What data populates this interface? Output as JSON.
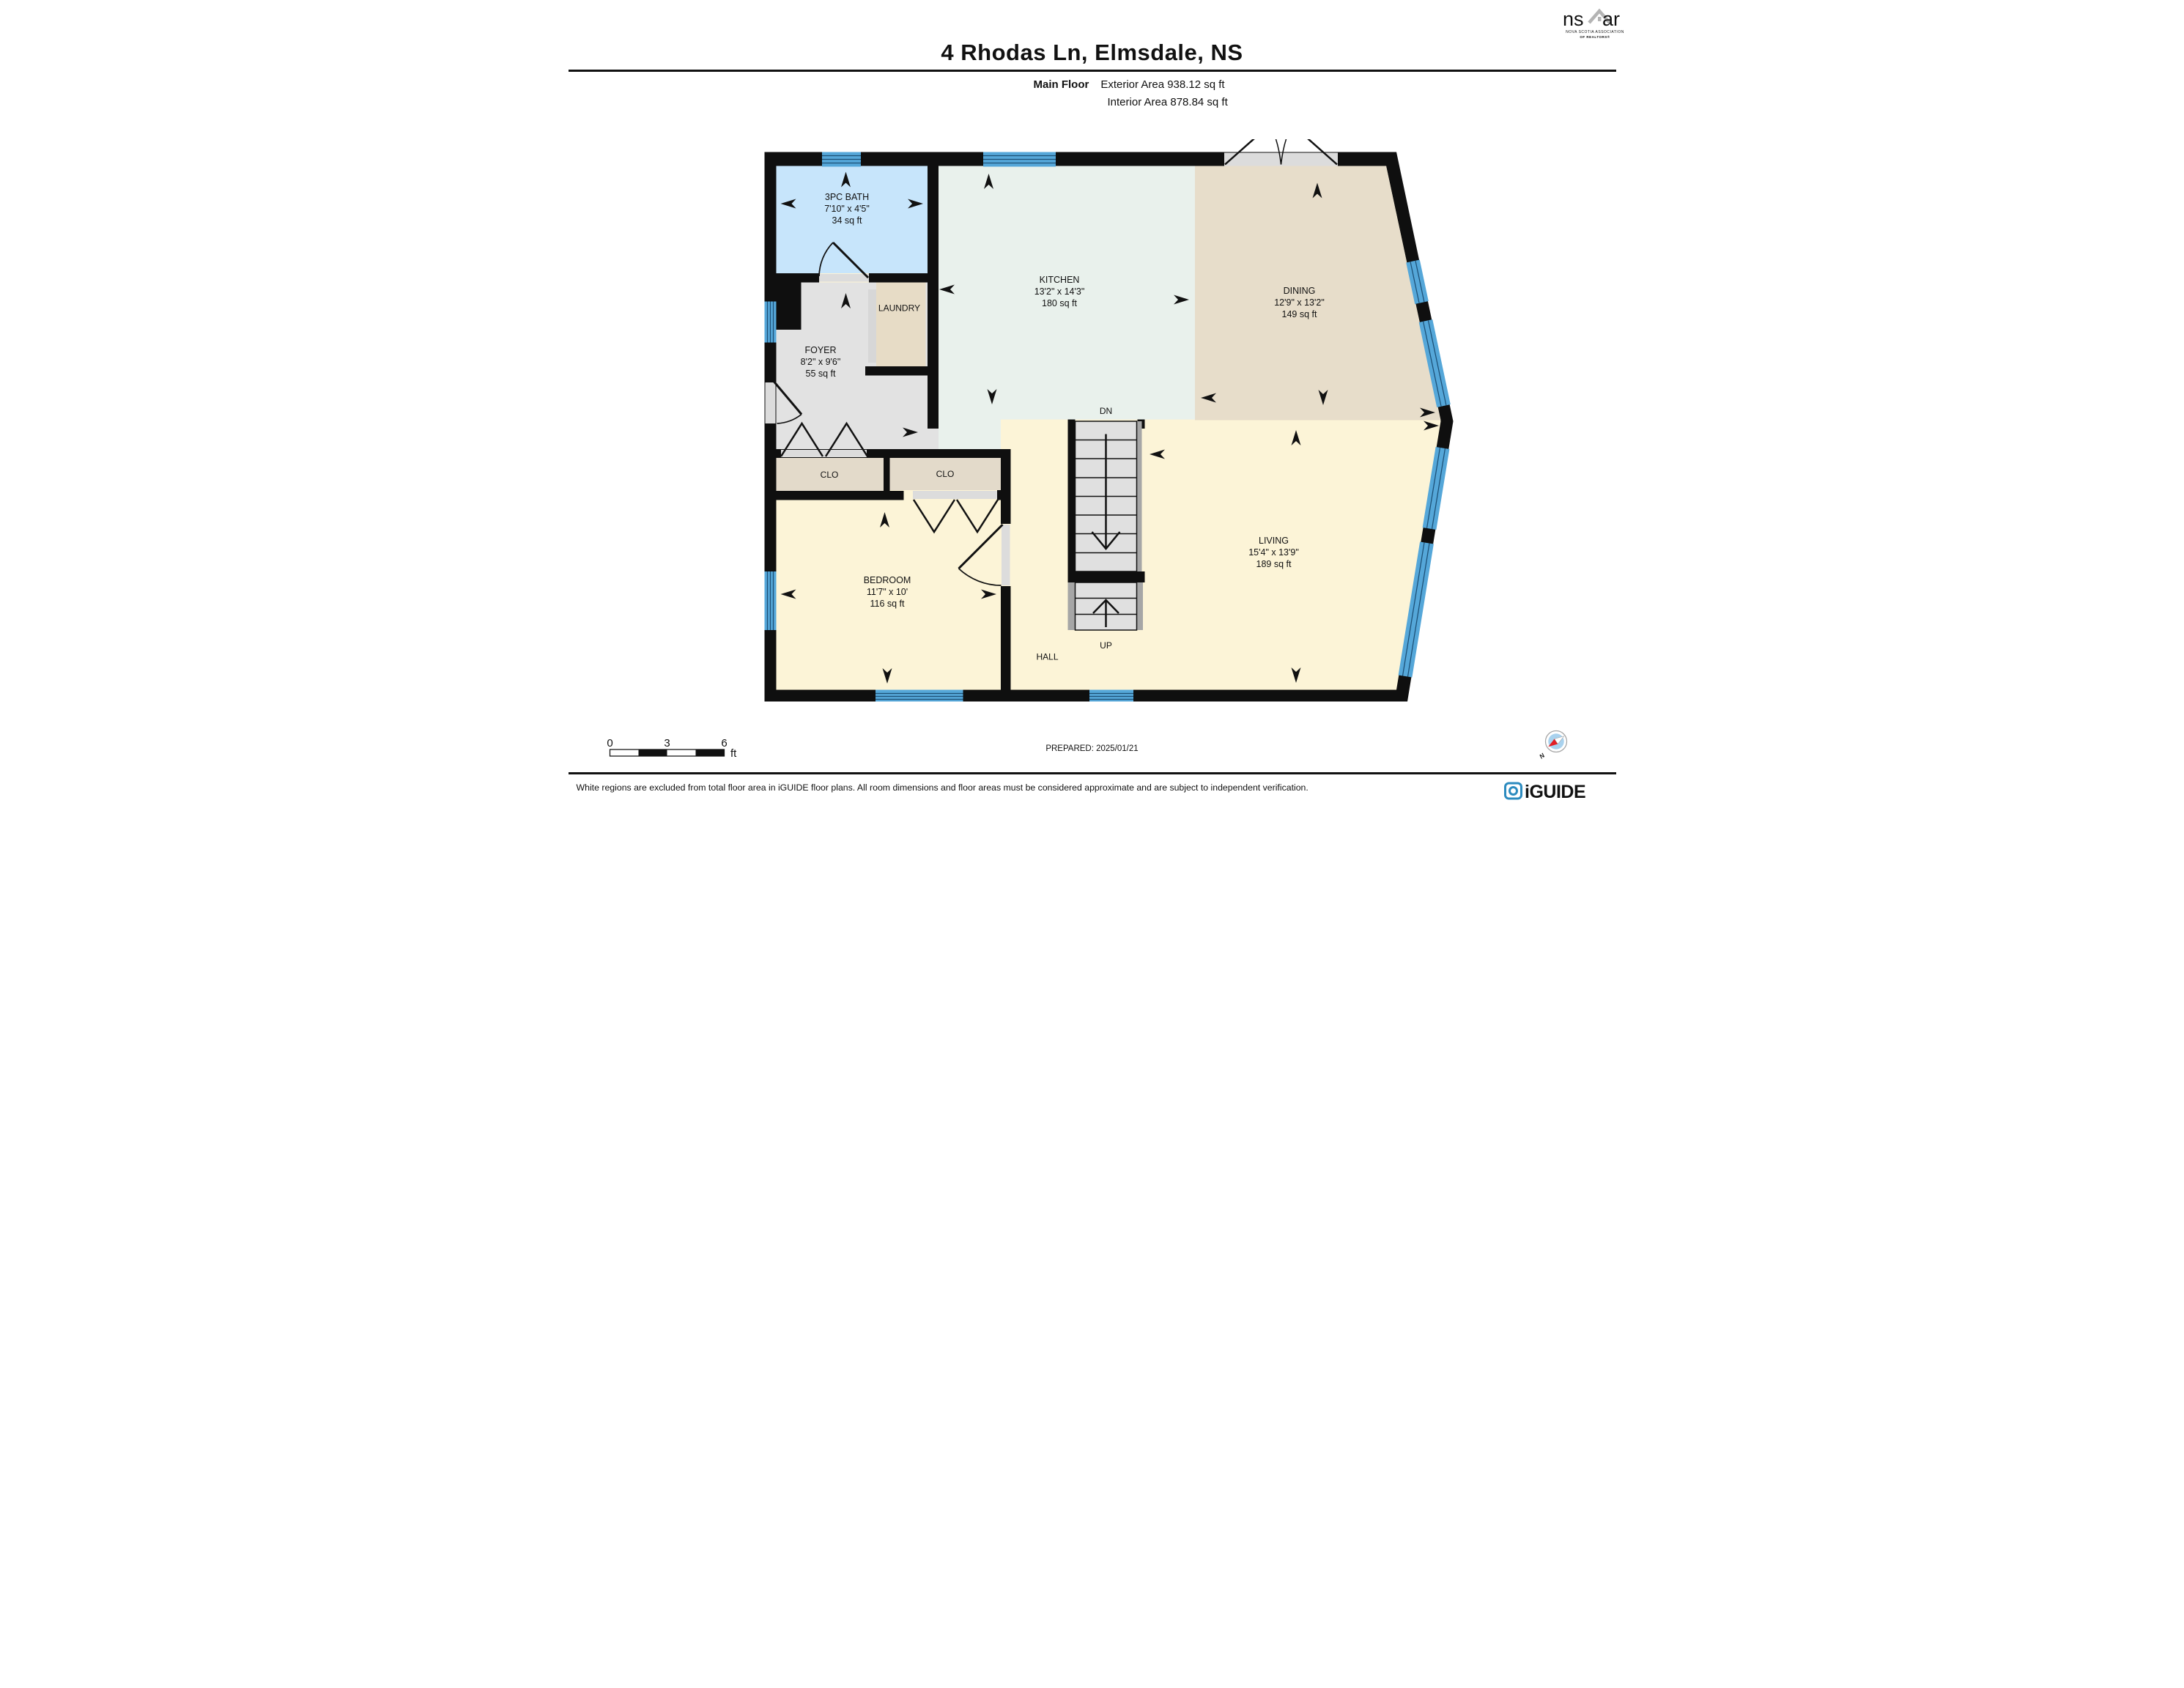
{
  "header": {
    "title": "4 Rhodas Ln, Elmsdale, NS",
    "floor_label": "Main Floor",
    "exterior_area": "Exterior Area 938.12 sq ft",
    "interior_area": "Interior Area 878.84 sq ft"
  },
  "rooms": {
    "bath": {
      "name": "3PC BATH",
      "dims": "7'10\" x 4'5\"",
      "area": "34 sq ft"
    },
    "kitchen": {
      "name": "KITCHEN",
      "dims": "13'2\" x 14'3\"",
      "area": "180 sq ft"
    },
    "dining": {
      "name": "DINING",
      "dims": "12'9\" x 13'2\"",
      "area": "149 sq ft"
    },
    "living": {
      "name": "LIVING",
      "dims": "15'4\" x 13'9\"",
      "area": "189 sq ft"
    },
    "bedroom": {
      "name": "BEDROOM",
      "dims": "11'7\" x 10'",
      "area": "116 sq ft"
    },
    "foyer": {
      "name": "FOYER",
      "dims": "8'2\" x 9'6\"",
      "area": "55 sq ft"
    },
    "laundry": {
      "name": "LAUNDRY"
    },
    "closet_left": {
      "name": "CLO"
    },
    "closet_right": {
      "name": "CLO"
    },
    "hall": {
      "name": "HALL"
    }
  },
  "stairs": {
    "down_label": "DN",
    "up_label": "UP"
  },
  "scale_bar": {
    "tick_0": "0",
    "tick_3": "3",
    "tick_6": "6",
    "unit": "ft"
  },
  "prepared_label": "PREPARED: 2025/01/21",
  "compass": {
    "north_label": "N"
  },
  "footer": {
    "disclaimer": "White regions are excluded from total floor area in iGUIDE floor plans. All room dimensions and floor areas must be considered approximate and are subject to independent verification."
  },
  "logos": {
    "nsar": {
      "left": "ns",
      "right": "ar",
      "caption_line1": "NOVA SCOTIA ASSOCIATION",
      "caption_line2": "OF REALTORS®"
    },
    "iguide": {
      "wordmark": "iGUIDE"
    }
  },
  "colors": {
    "wall": "#0f0f0f",
    "bath_floor": "#c7e5fb",
    "kitchen_floor": "#e9f1ec",
    "dining_floor": "#e7ddca",
    "cream_floor": "#fcf4d7",
    "foyer_floor": "#e2e2e2",
    "closet_floor": "#e3daca",
    "window_blue": "#55a7d9",
    "stair_tread": "#e0e0e0",
    "stair_rail": "#a6a6a6",
    "iguide_blue": "#2c8bbf",
    "nsar_gray": "#b4b4b4",
    "compass_red": "#e31e24"
  }
}
